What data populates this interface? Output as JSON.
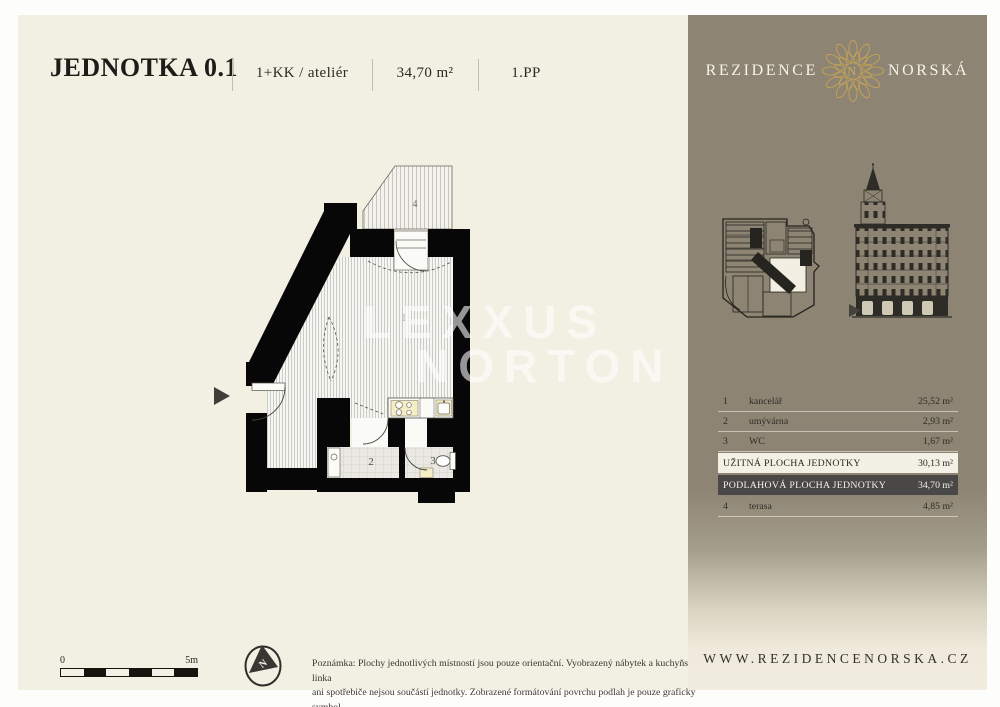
{
  "header": {
    "title": "JEDNOTKA 0.1",
    "layout": "1+KK / ateliér",
    "area": "34,70 m²",
    "floor": "1.PP"
  },
  "brand": {
    "left": "REZIDENCE",
    "right": "NORSKÁ",
    "monogram": "N",
    "website": "WWW.REZIDENCENORSKA.CZ"
  },
  "floorplan": {
    "watermark": {
      "line1": "LEXXUS",
      "line2": "NORTON"
    },
    "labels": {
      "r1": "1",
      "r2": "2",
      "r3": "3",
      "r4": "4"
    },
    "compass": "N"
  },
  "scalebar": {
    "start": "0",
    "end": "5m"
  },
  "note": {
    "line1": "Poznámka: Plochy jednotlivých místností jsou pouze orientační. Vyobrazený nábytek a kuchyňská linka",
    "line2": "ani spotřebiče nejsou součástí jednotky. Zobrazené formátování povrchu podlah je pouze grafický symbol."
  },
  "legend": {
    "rows": [
      {
        "num": "1",
        "name": "kancelář",
        "area": "25,52 m²"
      },
      {
        "num": "2",
        "name": "umývárna",
        "area": "2,93 m²"
      },
      {
        "num": "3",
        "name": "WC",
        "area": "1,67 m²"
      }
    ],
    "totals": [
      {
        "label": "UŽITNÁ PLOCHA JEDNOTKY",
        "area": "30,13 m²"
      },
      {
        "label": "PODLAHOVÁ PLOCHA JEDNOTKY",
        "area": "34,70 m²"
      }
    ],
    "extra": {
      "num": "4",
      "name": "terasa",
      "area": "4,85 m²"
    }
  },
  "colors": {
    "cream": "#f2efe3",
    "sidebar_taupe": "#8d8473",
    "gold": "#c3a257",
    "dark_row": "#4a4846",
    "light_row": "#f3f0e6",
    "wall_ink": "#070707"
  }
}
